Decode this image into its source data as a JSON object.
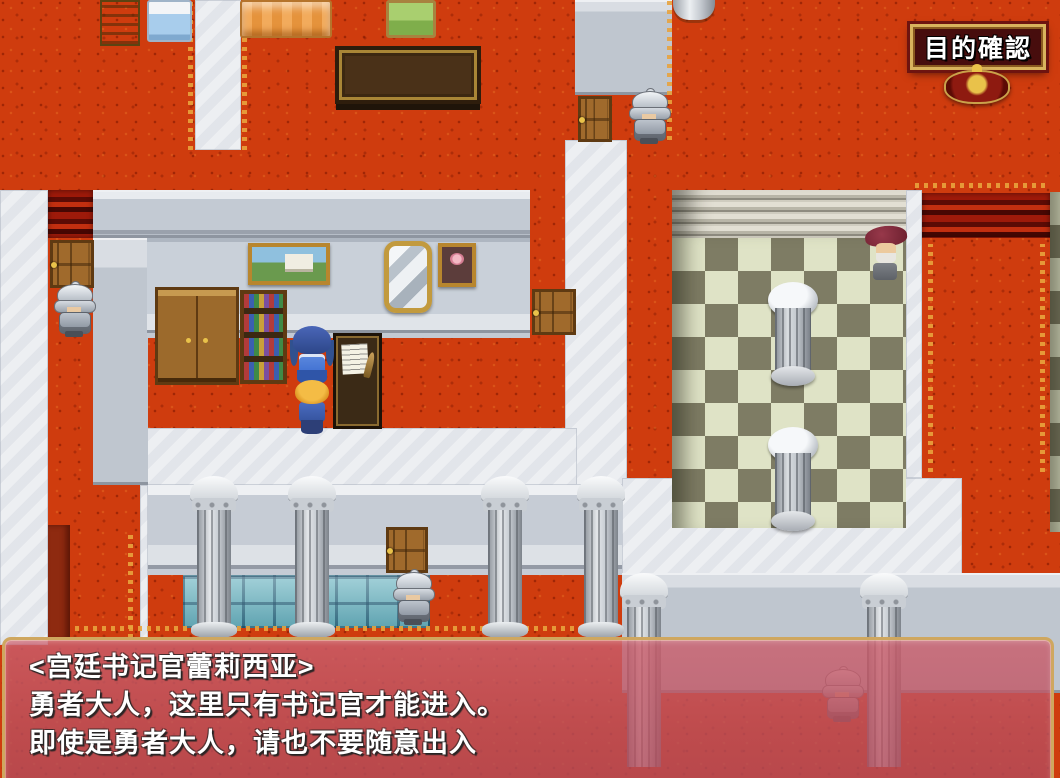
{
  "hud": {
    "objective_button": {
      "label": "目的確認"
    }
  },
  "dialogue": {
    "speaker": "<宫廷书记官蕾莉西亚>",
    "line1": "勇者大人，这里只有书记官才能进入。",
    "line2": "即使是勇者大人，请也不要随意出入"
  },
  "scene": {
    "npcs": [
      {
        "name": "court-scribe-lelicia",
        "hair_color": "#31518f"
      },
      {
        "name": "hero",
        "hair_color": "#e9a62a"
      },
      {
        "name": "guard-north",
        "armor_color": "#bcc3cc"
      },
      {
        "name": "guard-west",
        "armor_color": "#bcc3cc"
      },
      {
        "name": "guard-south",
        "armor_color": "#bcc3cc"
      },
      {
        "name": "guard-far-south",
        "armor_color": "#bcc3cc"
      },
      {
        "name": "elder-nobleman",
        "hat_color": "#7c2636"
      }
    ],
    "colors": {
      "carpet_red": "#cf3c0e",
      "carpet_trim_gold": "#e8a33d",
      "stone_white": "#edeff2",
      "wall_gray": "#bfc6cf",
      "checker_light": "#dfe3c6",
      "checker_dark": "#7e7c64",
      "glass_tile_teal": "#74bac6",
      "window_rose": "#c05a66",
      "window_border_gold": "#cfa75f",
      "badge_background": "#470d0d",
      "badge_border_gold": "#d9b35d"
    }
  }
}
